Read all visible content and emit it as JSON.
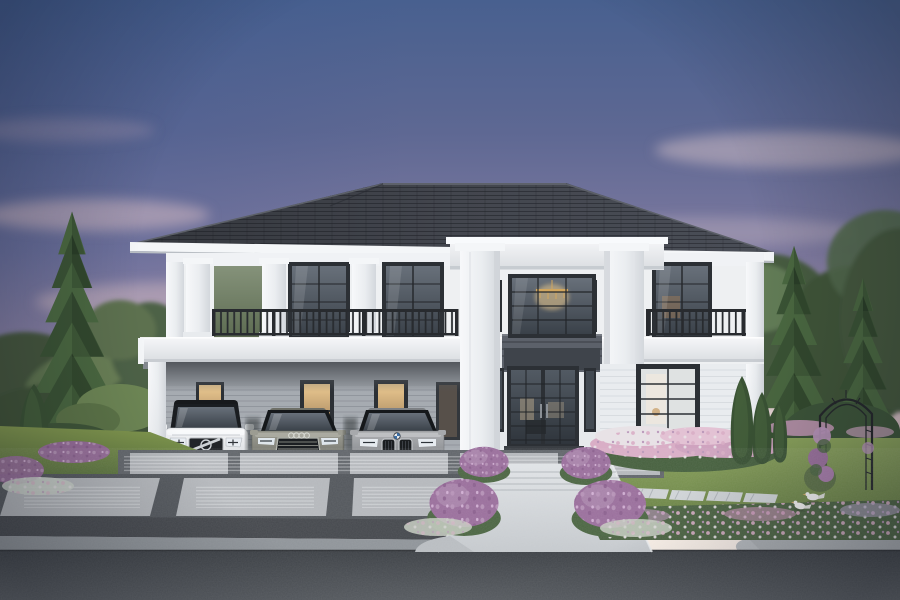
{
  "scene": {
    "title": "Two-story modern classical luxury house at dusk",
    "description": "Photorealistic dusk rendering of a white two-story modern-classical house with a charcoal hip roof, a double-height entry portico with large square columns, iron balcony railings, a carport sheltering three cars (white SUV, olive-gray sedan, silver sedan), manicured gardens with tall conical pines, purple and pink flower beds, a rose arch, two white doves on the lawn, a large-paver driveway, a white front walkway with steps, and a curbed asphalt road in the foreground.",
    "time_of_day": "dusk",
    "style": "architectural 3D render"
  },
  "elements": {
    "house": {
      "stories": 2,
      "wall_color_name": "white",
      "roof_type": "hip",
      "roof_color_name": "charcoal",
      "features": [
        "central double-height portico",
        "balconies with dark iron railings",
        "chandelier glowing in upper window",
        "glass front door",
        "attached flat-roof carport"
      ]
    },
    "cars": [
      {
        "label": "white SUV with black roof",
        "position": "carport left"
      },
      {
        "label": "olive-gray luxury sedan",
        "position": "carport middle"
      },
      {
        "label": "silver sedan",
        "position": "carport right"
      }
    ],
    "vegetation": [
      "tall conical pine left",
      "two tall pines right",
      "clipped cypress shrubs",
      "four purple flower bushes at walkway",
      "pink-white flower bed under right window",
      "green hedge with rose arch",
      "lawns"
    ],
    "birds": {
      "count": 2,
      "label": "white doves on right lawn"
    },
    "hardscape": [
      "large stone-paver driveway",
      "white front walkway with three steps",
      "diagonal stepping-stone path",
      "gray sidewalk with curved curb",
      "dark asphalt road"
    ]
  },
  "palette": {
    "skyTop": "#48608f",
    "skyUpper": "#5e6893",
    "skyMid": "#7e7aa0",
    "skyMauve": "#a691ab",
    "skyPink": "#cfb3bc",
    "skyCream": "#e7d9da",
    "skyHorizon": "#f1ecec",
    "cloud": "#dcc0c6",
    "glow": "#fff6ea",
    "roofDark": "#34373d",
    "roofMid": "#43464e",
    "roofEdge": "#5d616a",
    "fascia": "#f4f6f8",
    "wall": "#eef0f2",
    "wallShade": "#e3e7ea",
    "column": "#f7f8fa",
    "columnShade": "#d3d7dc",
    "frame": "#2c3035",
    "railing": "#282b2f",
    "glassTop": "#68707a",
    "glassBottom": "#3a4149",
    "warmGlow": "#e3bd85",
    "chandelier": "#e9c98e",
    "carportWall": "#a6abb1",
    "carportShade": "#53575d",
    "panelDark": "#5c616a",
    "lawnLight": "#8ba35c",
    "lawnDark": "#5f7a43",
    "pineDark": "#3a5334",
    "pineMid": "#4a6840",
    "pineLight": "#5e7d4c",
    "treeDeep": "#44563c",
    "treeSoft": "#5e7450",
    "hedge": "#3d5539",
    "flowerPurple": "#9a6f9c",
    "flowerLilac": "#b794b8",
    "flowerPink": "#d9aec6",
    "flowerWhite": "#e8e2e6",
    "foliage": "#4c6643",
    "paver": "#b5b8bc",
    "joint": "#53575c",
    "belt": "#45484d",
    "concrete": "#8f9499",
    "sidewalk": "#a9adb1",
    "walkway": "#d8dbde",
    "road": "#42464b",
    "carWhite": "#f0f2f4",
    "carRoofBlack": "#17191c",
    "carOlive": "#92928a",
    "carSilver": "#a7a9ac",
    "carGlass": "#333a41",
    "chrome": "#c9ccd0",
    "trunk": "#4e3d2e",
    "birdWhite": "#f5f5f3",
    "shadow": "#1c1f24"
  }
}
